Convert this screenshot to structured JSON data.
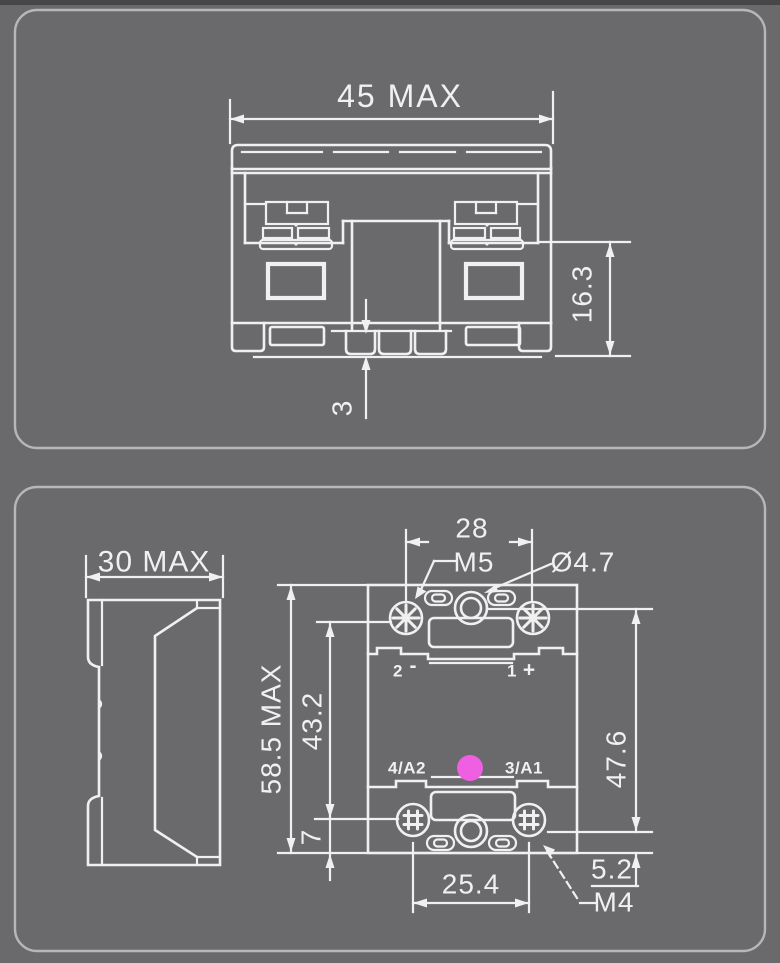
{
  "colors": {
    "page_bg": "#6a6a6c",
    "top_edge_strip": "#47474a",
    "panel_border": "#b7b7b9",
    "line": "#f0f0f1",
    "led": "#ee5fe2"
  },
  "front_view": {
    "width_dim": "45 MAX",
    "terminal_height_dim": "16.3",
    "standoff_dim": "3"
  },
  "side_view": {
    "depth_dim": "30 MAX"
  },
  "top_view": {
    "top_screw_spacing_dim": "28",
    "top_screw_thread": "M5",
    "mounting_hole_dia": "Ø4.7",
    "overall_height_dim": "58.5 MAX",
    "terminal_span_dim": "43.2",
    "mounting_hole_spacing_dim": "47.6",
    "bottom_terminal_offset_dim": "7",
    "mounting_hole_edge_dim": "5.2",
    "bottom_screw_spacing_dim": "25.4",
    "bottom_screw_thread": "M4",
    "terminals": {
      "top_left": {
        "num": "2",
        "sign": "-"
      },
      "top_right": {
        "num": "1",
        "sign": "+"
      },
      "bottom_left": "4/A2",
      "bottom_right": "3/A1"
    }
  }
}
